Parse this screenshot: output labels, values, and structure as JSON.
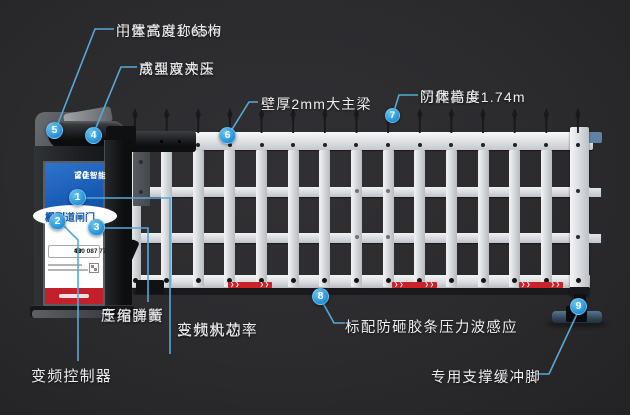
{
  "colors": {
    "accent_blue": "#2f9ce0",
    "leader_line": "#57a8d8",
    "brand_red": "#c2202b",
    "stripe_red": "#cc2128",
    "panel_blue": "#1a5fb4",
    "fence_white": "#e9ebee",
    "background": "#2b2c2e"
  },
  "callouts": {
    "c1": {
      "number": "1",
      "line1": "三代大功率",
      "line2": "变频机芯"
    },
    "c2": {
      "number": "2",
      "text": "变频控制器"
    },
    "c3": {
      "number": "3",
      "line1": "专用防断",
      "line2": "压缩弹簧"
    },
    "c4": {
      "number": "4",
      "feature": "高强度冲压",
      "spec": "成型双夹头"
    },
    "c5": {
      "number": "5",
      "feature": "中置式对称结构",
      "spec": "门体高度1.65m"
    },
    "c6": {
      "number": "6",
      "text": "壁厚2mm大主梁"
    },
    "c7": {
      "number": "7",
      "feature": "防爬枪尖",
      "spec": "门体高度1.74m"
    },
    "c8": {
      "number": "8",
      "text": "标配防砸胶条压力波感应"
    },
    "c9": {
      "number": "9",
      "text": "专用支撑缓冲脚"
    }
  },
  "cabinet_panel": {
    "logo_text": "百佳智能",
    "logo_year": "20",
    "series_line1": "系列",
    "series_line2": "栅型道闸门",
    "hotline_icon": "☎",
    "hotline": "400 087 7707"
  }
}
